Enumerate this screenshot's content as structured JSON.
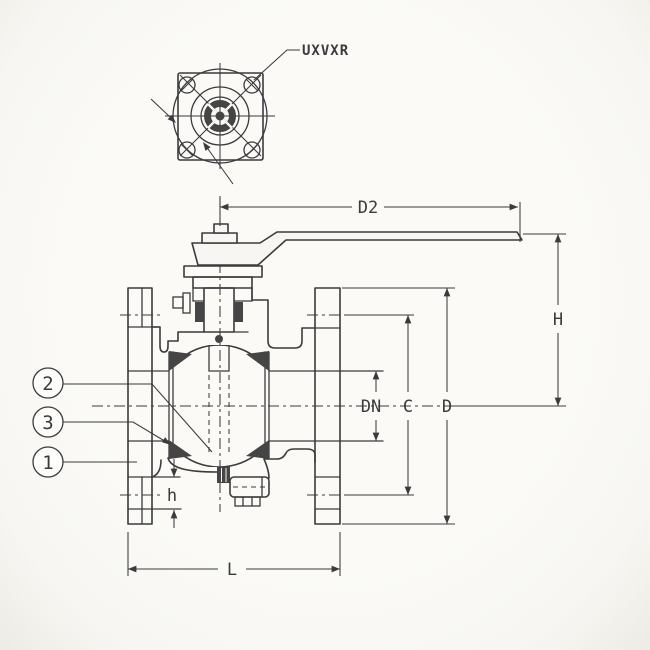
{
  "drawing": {
    "top_view": {
      "mounting_pad_label": "UXVXR"
    },
    "dimensions": {
      "handle_length": "D2",
      "height": "H",
      "nominal_bore": "DN",
      "bolt_circle": "C",
      "flange_od": "D",
      "bolt_boss_height": "h",
      "face_to_face": "L"
    },
    "balloons": [
      {
        "label": "2"
      },
      {
        "label": "3"
      },
      {
        "label": "1"
      }
    ],
    "colors": {
      "paper": "#f7f6f2",
      "ink": "#3b3b3d",
      "dark": "#454545"
    }
  }
}
